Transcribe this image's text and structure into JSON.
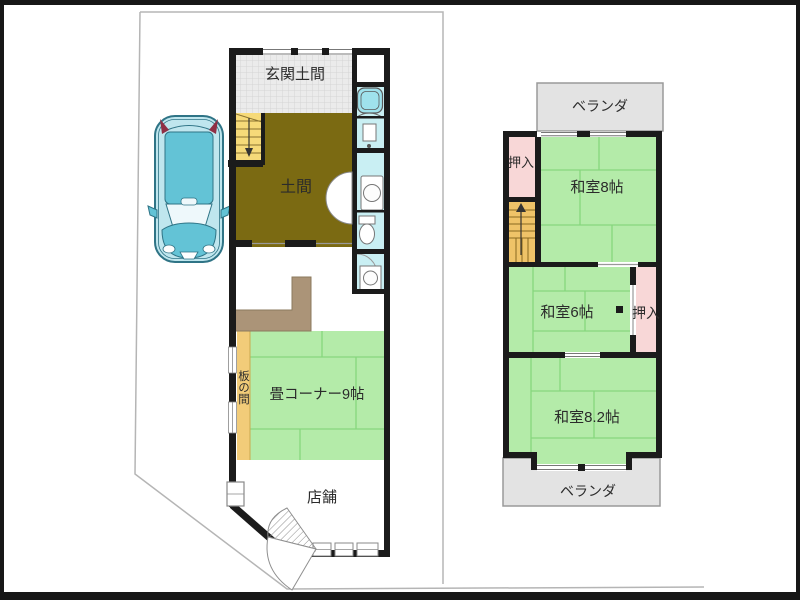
{
  "plan1": {
    "rooms": {
      "genkan_doma": "玄関土間",
      "doma": "土間",
      "ita_no_ma": "板の間",
      "tatami_corner": "畳コーナー9帖",
      "shop": "店舗"
    }
  },
  "plan2": {
    "veranda_top": "ベランダ",
    "veranda_bottom": "ベランダ",
    "closet_upper": "押入",
    "closet_middle": "押入",
    "washitsu_8": "和室8帖",
    "washitsu_6": "和室6帖",
    "washitsu_8_2": "和室8.2帖"
  },
  "colors": {
    "frame_black": "#171717",
    "wall_black": "#1b1b1b",
    "boundary_gray": "#b5b5b5",
    "genkan_gray": "#ebebeb",
    "doma_olive": "#7b6a12",
    "stairs_yellow": "#f6da79",
    "stairs2_orange": "#efc368",
    "tatami_green": "#b4eba9",
    "tatami_line": "#86d67e",
    "wood_floor": "#f2cc79",
    "counter_tan": "#ab9478",
    "wet_area_cyan": "#c9eff3",
    "tub_cyan": "#9fe2ec",
    "closet_pink": "#f8d7d7",
    "veranda_gray": "#e3e3e3",
    "car_body": "#bfe6ee",
    "car_roof": "#63c3d6",
    "car_accent_red": "#8f2f45"
  }
}
